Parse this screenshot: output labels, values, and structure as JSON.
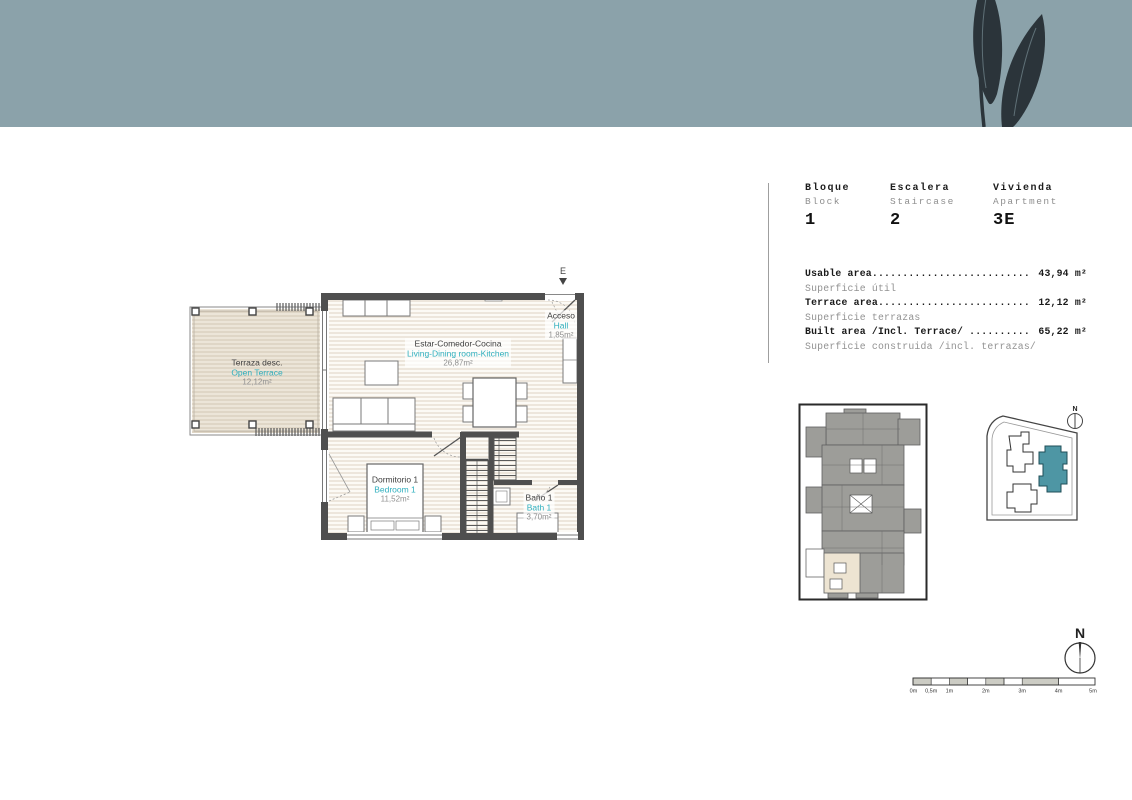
{
  "colors": {
    "banner": "#8ba2aa",
    "leaf": "#2b343a",
    "accent": "#2fafbe",
    "wall": "#4f4f4f",
    "floor_line": "#ded3c3",
    "terrace_fill": "#ece5d8",
    "terrace_line": "#d2c6b4",
    "text_dark": "#3f3f3f",
    "text_gray": "#8f8f8f",
    "keyplan_gray": "#9d9d99",
    "keyplan_highlight": "#ede4d2",
    "site_highlight": "#4e96a4",
    "scale_fill": "#ccccc4"
  },
  "unit_header": {
    "columns": [
      {
        "label_es": "Bloque",
        "label_en": "Block",
        "value": "1"
      },
      {
        "label_es": "Escalera",
        "label_en": "Staircase",
        "value": "2"
      },
      {
        "label_es": "Vivienda",
        "label_en": "Apartment",
        "value": "3E"
      }
    ]
  },
  "area_table": {
    "leader": "......................................................",
    "rows": [
      {
        "label_en": "Usable area",
        "label_es": "Superficie útil",
        "value": "43,94 m²"
      },
      {
        "label_en": "Terrace area",
        "label_es": "Superficie terrazas",
        "value": "12,12 m²"
      },
      {
        "label_en": "Built area /Incl. Terrace/ ",
        "label_es": "Superficie construida /incl. terrazas/",
        "value": "65,22 m²"
      }
    ]
  },
  "floor_plan": {
    "entrance_label": "E",
    "rooms": [
      {
        "id": "terrace",
        "name_es": "Terraza desc.",
        "name_en": "Open Terrace",
        "area": "12,12m²"
      },
      {
        "id": "living",
        "name_es": "Estar-Comedor-Cocina",
        "name_en": "Living-Dining room-Kitchen",
        "area": "26,87m²"
      },
      {
        "id": "hall",
        "name_es": "Acceso",
        "name_en": "Hall",
        "area": "1,85m²"
      },
      {
        "id": "bedroom",
        "name_es": "Dormitorio 1",
        "name_en": "Bedroom 1",
        "area": "11,52m²"
      },
      {
        "id": "bath",
        "name_es": "Baño 1",
        "name_en": "Bath 1",
        "area": "3,70m²"
      }
    ]
  },
  "site_plan": {
    "compass_label": "N"
  },
  "compass": {
    "label": "N"
  },
  "scale_bar": {
    "labels": [
      "0m",
      "0,5m",
      "1m",
      "2m",
      "3m",
      "4m",
      "5m"
    ]
  }
}
